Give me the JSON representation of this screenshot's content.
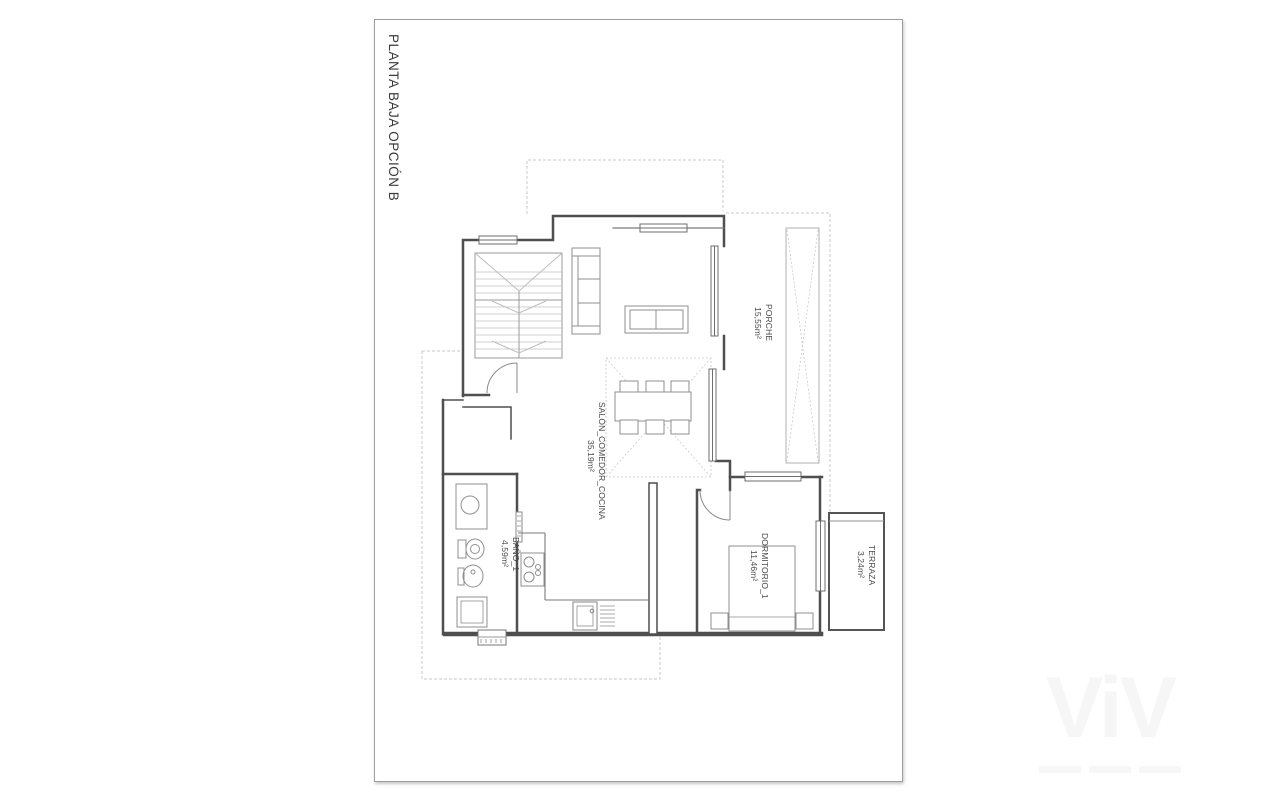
{
  "sheet": {
    "title": "PLANTA BAJA OPCIÓN B",
    "background": "#ffffff",
    "frame_border": "#9e9e9e"
  },
  "colors": {
    "wall": "#4f4f4f",
    "line_medium": "#7a7a7a",
    "furniture_line": "#8f8f8f",
    "dashed_line": "#c9c9c9",
    "label_text": "#474747",
    "watermark": "#f6f6f6"
  },
  "rooms": [
    {
      "name": "PORCHE",
      "area": "15,55m²"
    },
    {
      "name": "SALÓN_COMEDOR_COCINA",
      "area": "35,19m²"
    },
    {
      "name": "BAÑO_1",
      "area": "4,59m²"
    },
    {
      "name": "DORMITORIO_1",
      "area": "11,46m²"
    },
    {
      "name": "TERRAZA",
      "area": "3,24m²"
    }
  ],
  "watermark": {
    "text": "ViV"
  }
}
